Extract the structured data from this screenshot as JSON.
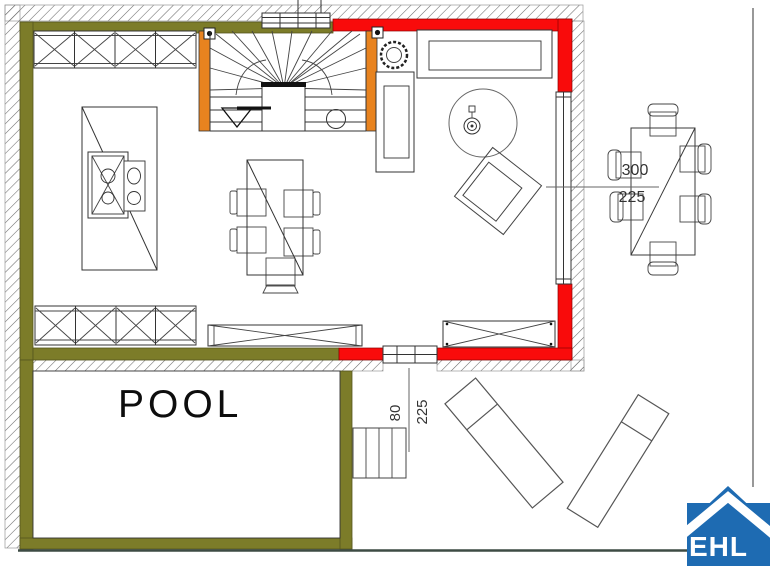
{
  "colors": {
    "wall_olive": "#7C7C29",
    "wall_red": "#F90B0B",
    "post_orange": "#E8831F",
    "logo_blue": "#1E6BB2",
    "boundary_dark": "#3D4B44"
  },
  "labels": {
    "pool": "POOL"
  },
  "dimensions": {
    "terrace": {
      "width": "300",
      "depth": "225"
    },
    "steps": {
      "width": "80",
      "depth": "225"
    }
  },
  "logo": {
    "text": "EHL"
  }
}
